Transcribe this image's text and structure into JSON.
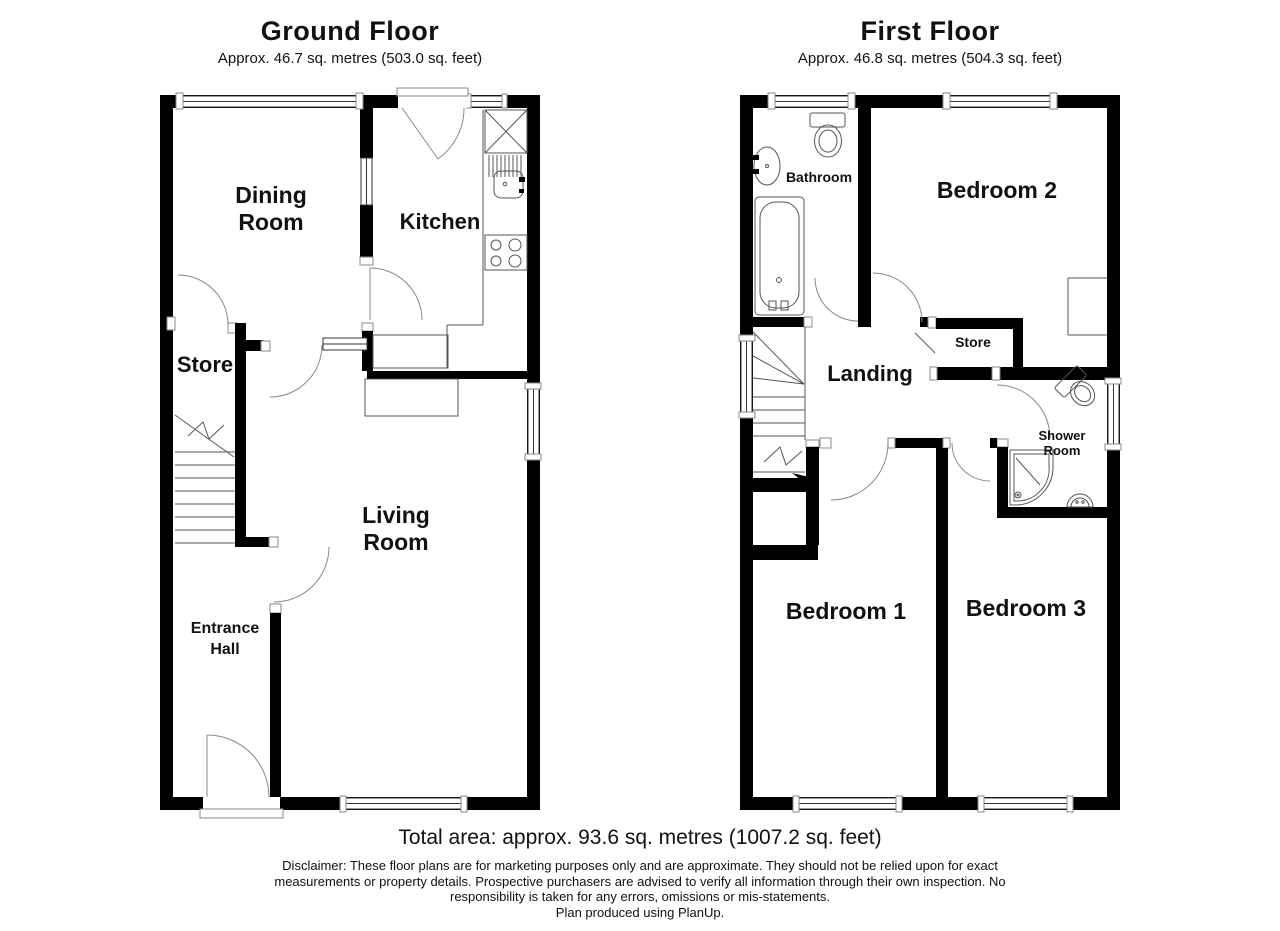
{
  "colors": {
    "wall": "#000000",
    "background": "#ffffff",
    "fixture_line": "#555555",
    "door_arc": "#888888",
    "text": "#111111"
  },
  "ground_floor": {
    "title": "Ground Floor",
    "subtitle": "Approx. 46.7 sq. metres (503.0 sq. feet)",
    "rooms": {
      "dining_room": {
        "line1": "Dining",
        "line2": "Room"
      },
      "kitchen": {
        "label": "Kitchen"
      },
      "store": {
        "label": "Store"
      },
      "living_room": {
        "line1": "Living",
        "line2": "Room"
      },
      "entrance_hall": {
        "line1": "Entrance",
        "line2": "Hall"
      }
    }
  },
  "first_floor": {
    "title": "First Floor",
    "subtitle": "Approx. 46.8 sq. metres (504.3 sq. feet)",
    "rooms": {
      "bathroom": {
        "label": "Bathroom"
      },
      "bedroom_2": {
        "label": "Bedroom 2"
      },
      "landing": {
        "label": "Landing"
      },
      "store": {
        "label": "Store"
      },
      "shower_room": {
        "line1": "Shower",
        "line2": "Room"
      },
      "bedroom_1": {
        "label": "Bedroom 1"
      },
      "bedroom_3": {
        "label": "Bedroom 3"
      }
    }
  },
  "footer": {
    "total_area": "Total area: approx. 93.6 sq. metres (1007.2 sq. feet)",
    "disclaimer_line1": "Disclaimer: These floor plans are for marketing purposes only and are approximate. They should not be relied upon for exact",
    "disclaimer_line2": "measurements or property details. Prospective purchasers are advised to verify all information through their own inspection. No",
    "disclaimer_line3": "responsibility is taken for any errors, omissions or mis-statements.",
    "credit": "Plan produced using PlanUp."
  }
}
